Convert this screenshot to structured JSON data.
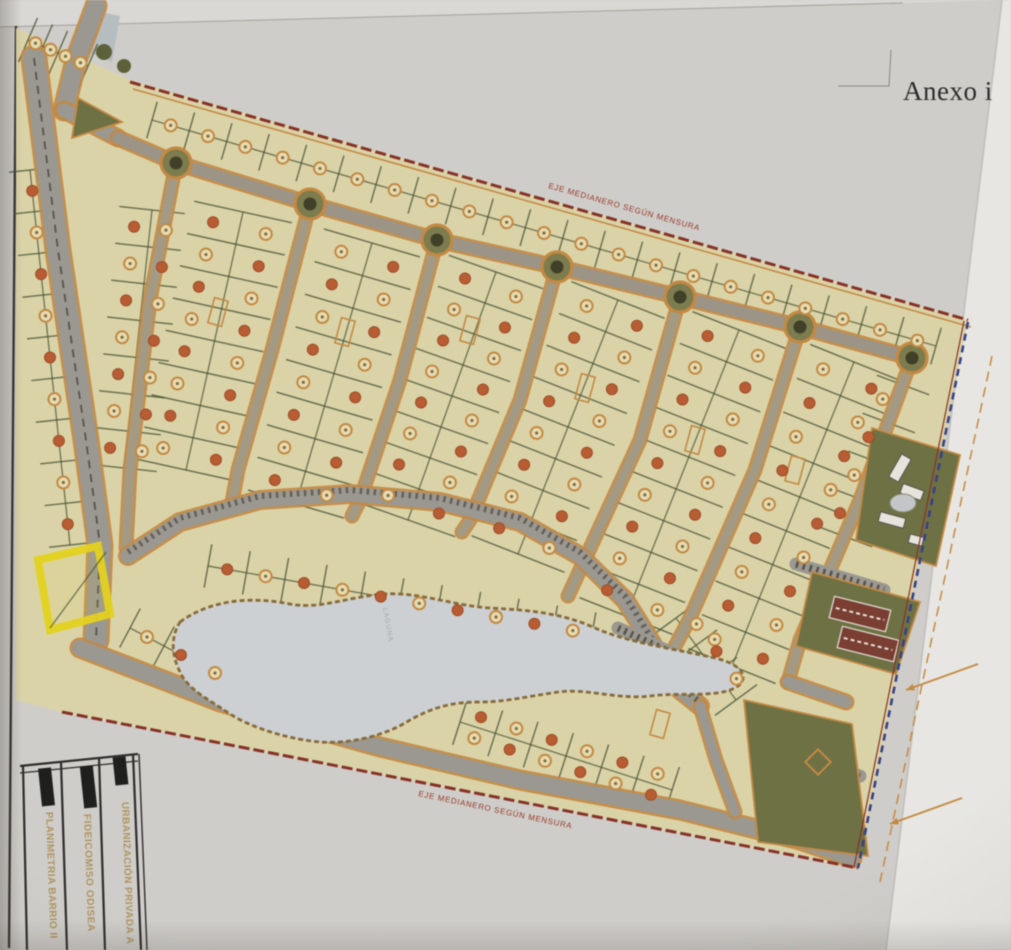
{
  "page": {
    "annotation": "Anexo i"
  },
  "title_block": {
    "rows": [
      {
        "label": "PLANIMETRIA BARRIO II"
      },
      {
        "label": "FIDEICOMISO ODISEA"
      },
      {
        "label": "URBANIZACIÓN PRIVADA A"
      }
    ]
  },
  "map": {
    "labels": {
      "top_boundary": "EJE MEDIANERO SEGÚN MENSURA",
      "bottom_boundary": "EJE MEDIANERO SEGÚN MENSURA",
      "lake": "LAGUNA"
    },
    "palette": {
      "paper": "#d1cfca",
      "paper_light": "#dcdad6",
      "backing": "#e9e8e4",
      "site_beige": "#ddd5a6",
      "road_gray": "#9b9890",
      "road_tan": "#a59b82",
      "street_casing": "#c9893c",
      "lot_line": "#44502e",
      "boundary_red": "#8c2f23",
      "boundary_blue": "#33418c",
      "lake_fill": "#cdd2d4",
      "lake_edge": "#8a6a34",
      "green_area": "#6e7140",
      "court_red": "#7e3c30",
      "tree_solid": "#bf5b2d",
      "tree_ring": "#c9893c",
      "tree_ring_fill": "#e6deb2",
      "highlight_yellow": "#e8d411",
      "hatch_dark": "#57534a",
      "title_text": "#b1945e"
    },
    "site_outline": [
      [
        16,
        28
      ],
      [
        130,
        80
      ],
      [
        968,
        320
      ],
      [
        858,
        868
      ],
      [
        62,
        712
      ],
      [
        16,
        700
      ]
    ],
    "boundaries": {
      "top": [
        [
          130,
          82
        ],
        [
          968,
          320
        ]
      ],
      "bottom": [
        [
          62,
          712
        ],
        [
          858,
          868
        ]
      ],
      "right": [
        [
          968,
          322
        ],
        [
          858,
          868
        ]
      ],
      "reserve_dashed": [
        [
          992,
          356
        ],
        [
          880,
          882
        ]
      ]
    },
    "roundabouts": [
      [
        176,
        163
      ],
      [
        310,
        204
      ],
      [
        437,
        240
      ],
      [
        557,
        267
      ],
      [
        680,
        297
      ],
      [
        800,
        327
      ],
      [
        912,
        358
      ]
    ],
    "roads": {
      "collector": [
        [
          118,
          138
        ],
        [
          176,
          163
        ],
        [
          310,
          204
        ],
        [
          437,
          240
        ],
        [
          557,
          267
        ],
        [
          680,
          297
        ],
        [
          800,
          327
        ],
        [
          912,
          358
        ]
      ],
      "verticals": [
        [
          [
            176,
            163
          ],
          [
            150,
            300
          ],
          [
            130,
            470
          ],
          [
            126,
            548
          ]
        ],
        [
          [
            310,
            204
          ],
          [
            272,
            350
          ],
          [
            238,
            470
          ],
          [
            232,
            502
          ]
        ],
        [
          [
            437,
            240
          ],
          [
            400,
            380
          ],
          [
            360,
            500
          ],
          [
            352,
            516
          ]
        ],
        [
          [
            557,
            267
          ],
          [
            520,
            400
          ],
          [
            470,
            520
          ],
          [
            462,
            532
          ]
        ],
        [
          [
            680,
            297
          ],
          [
            640,
            440
          ],
          [
            580,
            570
          ],
          [
            568,
            596
          ]
        ],
        [
          [
            800,
            327
          ],
          [
            755,
            470
          ],
          [
            690,
            618
          ],
          [
            672,
            652
          ]
        ],
        [
          [
            912,
            358
          ],
          [
            860,
            500
          ],
          [
            800,
            640
          ],
          [
            788,
            682
          ]
        ]
      ],
      "arc": [
        [
          128,
          556
        ],
        [
          180,
          522
        ],
        [
          260,
          500
        ],
        [
          350,
          494
        ],
        [
          440,
          502
        ],
        [
          520,
          522
        ],
        [
          580,
          556
        ],
        [
          625,
          600
        ],
        [
          655,
          648
        ],
        [
          680,
          690
        ],
        [
          700,
          706
        ]
      ],
      "bottom_road": [
        [
          80,
          648
        ],
        [
          220,
          702
        ],
        [
          380,
          747
        ],
        [
          520,
          780
        ],
        [
          680,
          810
        ],
        [
          800,
          840
        ],
        [
          852,
          858
        ]
      ],
      "boulevard": [
        [
          34,
          58
        ],
        [
          58,
          250
        ],
        [
          86,
          440
        ],
        [
          100,
          545
        ],
        [
          96,
          640
        ]
      ],
      "entry_top": [
        [
          96,
          6
        ],
        [
          76,
          60
        ],
        [
          64,
          110
        ]
      ],
      "entry_link": [
        [
          64,
          110
        ],
        [
          118,
          138
        ]
      ],
      "arc_bottom_link": [
        [
          700,
          706
        ],
        [
          716,
          760
        ],
        [
          735,
          812
        ]
      ],
      "east_link": [
        [
          788,
          682
        ],
        [
          846,
          702
        ]
      ]
    },
    "blocks": [
      {
        "name": "top-strip",
        "a": [
          152,
          120
        ],
        "b": [
          936,
          346
        ],
        "half": 19,
        "lots": 21,
        "tree_offsets": [
          0
        ],
        "tree_type": "ring"
      },
      {
        "name": "block-1",
        "a": [
          243,
          212
        ],
        "b": [
          186,
          470
        ],
        "half": 50,
        "lots": 8,
        "tree_offsets": [
          -27,
          27
        ],
        "tree_type": "mix"
      },
      {
        "name": "block-2",
        "a": [
          372,
          243
        ],
        "b": [
          296,
          504
        ],
        "half": 50,
        "lots": 8,
        "tree_offsets": [
          -27,
          27
        ],
        "tree_type": "mix"
      },
      {
        "name": "block-3",
        "a": [
          496,
          272
        ],
        "b": [
          408,
          520
        ],
        "half": 50,
        "lots": 8,
        "tree_offsets": [
          -27,
          27
        ],
        "tree_type": "mix"
      },
      {
        "name": "block-4",
        "a": [
          618,
          300
        ],
        "b": [
          518,
          554
        ],
        "half": 50,
        "lots": 8,
        "tree_offsets": [
          -27,
          27
        ],
        "tree_type": "mix"
      },
      {
        "name": "block-5",
        "a": [
          739,
          330
        ],
        "b": [
          626,
          616
        ],
        "half": 50,
        "lots": 9,
        "tree_offsets": [
          -27,
          27
        ],
        "tree_type": "mix"
      },
      {
        "name": "block-6",
        "a": [
          854,
          362
        ],
        "b": [
          732,
          666
        ],
        "half": 47,
        "lots": 9,
        "tree_offsets": [
          -26,
          26
        ],
        "tree_type": "mix"
      },
      {
        "name": "block-0",
        "a": [
          152,
          210
        ],
        "b": [
          124,
          468
        ],
        "half": 33,
        "lots": 7,
        "tree_offsets": [
          -16,
          16
        ],
        "tree_type": "mix"
      },
      {
        "name": "left-col",
        "a": [
          30,
          170
        ],
        "b": [
          70,
          545
        ],
        "half": 21,
        "lots": 9,
        "tree_offsets": [
          0
        ],
        "tree_type": "mix"
      },
      {
        "name": "ne-col",
        "a": [
          903,
          385
        ],
        "b": [
          846,
          537
        ],
        "half": 28,
        "lots": 4,
        "tree_offsets": [
          14
        ],
        "tree_type": "mix"
      },
      {
        "name": "lake-north",
        "a": [
          208,
          566
        ],
        "b": [
          592,
          634
        ],
        "half": 22,
        "lots": 10,
        "tree_offsets": [
          0
        ],
        "tree_type": "mix"
      },
      {
        "name": "south-west",
        "a": [
          130,
          628
        ],
        "b": [
          232,
          682
        ],
        "half": 22,
        "lots": 3,
        "tree_offsets": [
          0
        ],
        "tree_type": "mix"
      },
      {
        "name": "south-east",
        "a": [
          460,
          722
        ],
        "b": [
          672,
          790
        ],
        "half": 24,
        "lots": 6,
        "tree_offsets": [
          -11,
          11
        ],
        "tree_type": "mix"
      },
      {
        "name": "east-lake",
        "a": [
          676,
          618
        ],
        "b": [
          736,
          700
        ],
        "half": 26,
        "lots": 3,
        "tree_offsets": [
          -13
        ],
        "tree_type": "mix"
      },
      {
        "name": "tl-corner",
        "a": [
          28,
          40
        ],
        "b": [
          88,
          66
        ],
        "half": 24,
        "lots": 4,
        "tree_offsets": [
          0
        ],
        "tree_type": "ring"
      }
    ],
    "lake_path": "M 180,622 C 210,600 250,596 290,604 C 320,610 350,596 385,594 C 420,592 455,606 490,608 C 525,610 560,612 595,628 C 625,642 680,650 715,658 C 745,665 750,680 735,688 C 715,698 680,692 650,696 C 620,700 585,688 558,692 C 530,696 505,702 480,702 C 450,702 432,708 410,720 C 385,736 350,744 320,742 C 295,740 255,730 230,714 C 210,700 188,690 180,672 C 172,656 170,638 180,622 Z",
    "highlight_square": [
      [
        38,
        560
      ],
      [
        98,
        546
      ],
      [
        110,
        614
      ],
      [
        50,
        630
      ]
    ],
    "greens": [
      {
        "name": "club-area",
        "pts": [
          [
            872,
            428
          ],
          [
            960,
            455
          ],
          [
            936,
            566
          ],
          [
            856,
            540
          ]
        ]
      },
      {
        "name": "courts-area",
        "pts": [
          [
            812,
            572
          ],
          [
            920,
            602
          ],
          [
            896,
            674
          ],
          [
            796,
            646
          ]
        ]
      },
      {
        "name": "south-amenity",
        "pts": [
          [
            744,
            700
          ],
          [
            852,
            724
          ],
          [
            868,
            856
          ],
          [
            758,
            842
          ]
        ]
      },
      {
        "name": "entry-median",
        "pts": [
          [
            78,
            98
          ],
          [
            122,
            122
          ],
          [
            72,
            138
          ]
        ]
      }
    ],
    "courts": [
      {
        "cx": 860,
        "cy": 614,
        "w": 58,
        "h": 22,
        "rot": 14
      },
      {
        "cx": 868,
        "cy": 644,
        "w": 58,
        "h": 22,
        "rot": 14
      }
    ],
    "buildings": [
      {
        "cx": 900,
        "cy": 468,
        "w": 26,
        "h": 11,
        "rot": -60
      },
      {
        "cx": 912,
        "cy": 492,
        "w": 22,
        "h": 10,
        "rot": 20
      },
      {
        "cx": 892,
        "cy": 520,
        "w": 26,
        "h": 10,
        "rot": 15
      },
      {
        "cx": 916,
        "cy": 540,
        "w": 14,
        "h": 9,
        "rot": 15
      }
    ],
    "pond": {
      "cx": 903,
      "cy": 503,
      "rx": 13,
      "ry": 9
    },
    "parking_strips": [
      [
        [
          796,
          564
        ],
        [
          884,
          590
        ]
      ],
      [
        [
          806,
          758
        ],
        [
          860,
          776
        ]
      ],
      [
        [
          618,
          628
        ],
        [
          678,
          656
        ]
      ],
      [
        [
          772,
          712
        ],
        [
          836,
          730
        ]
      ]
    ],
    "footprint_rects": [
      {
        "cx": 218,
        "cy": 312
      },
      {
        "cx": 345,
        "cy": 332
      },
      {
        "cx": 470,
        "cy": 330
      },
      {
        "cx": 585,
        "cy": 388
      },
      {
        "cx": 695,
        "cy": 440
      },
      {
        "cx": 795,
        "cy": 470
      },
      {
        "cx": 660,
        "cy": 724
      }
    ],
    "entry_patch": [
      [
        92,
        10
      ],
      [
        120,
        16
      ],
      [
        112,
        62
      ],
      [
        88,
        52
      ]
    ],
    "entry_blobs": [
      [
        104,
        52,
        8
      ],
      [
        124,
        66,
        7
      ]
    ],
    "diamond": {
      "cx": 818,
      "cy": 762
    },
    "reserve_arrows": [
      {
        "from": [
          978,
          664
        ],
        "to": [
          906,
          690
        ]
      },
      {
        "from": [
          962,
          798
        ],
        "to": [
          890,
          824
        ]
      }
    ]
  }
}
